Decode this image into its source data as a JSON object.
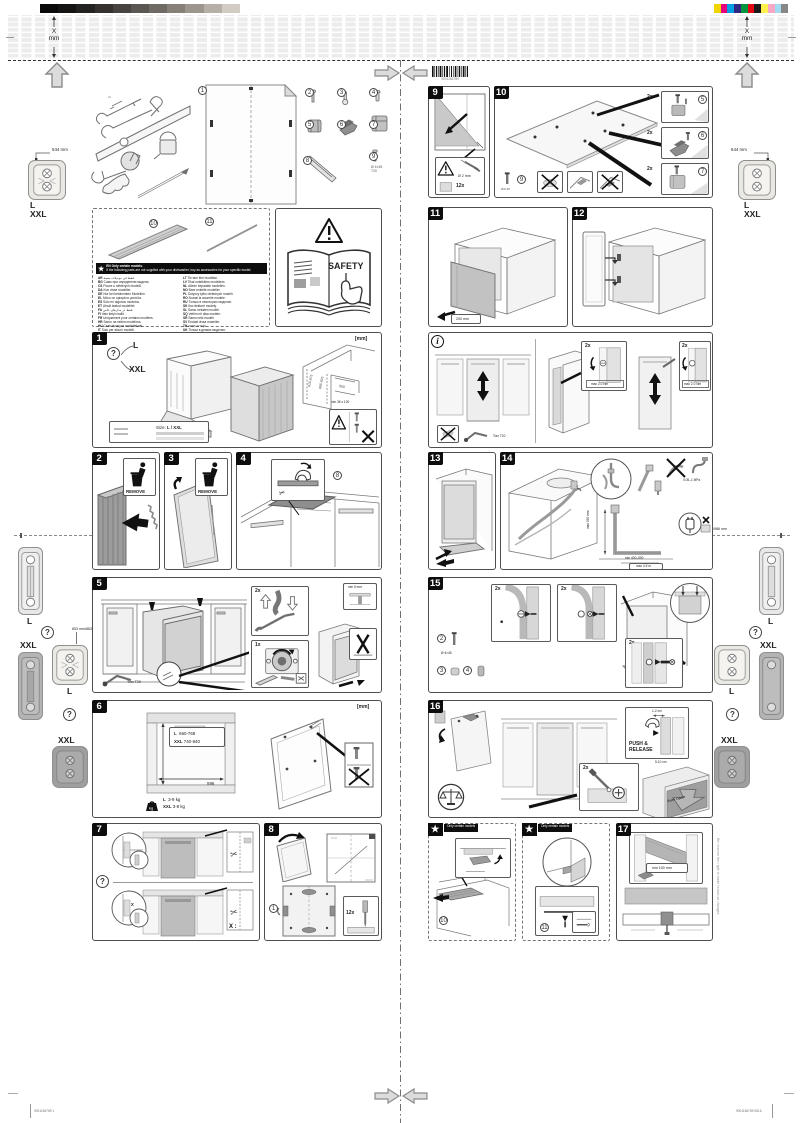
{
  "print": {
    "x_label": "X",
    "mm_label": "mm",
    "barcode_text": "9001156789",
    "footer_left": "9001156789 1",
    "footer_right": "9001156789  0816"
  },
  "flaps": {
    "dim_top": "544 mm",
    "dim_mid_left": "853 mm/863 mm",
    "dim_mid_right": "966 mm/986 mm",
    "l": "L",
    "xxl": "XXL",
    "q": "?"
  },
  "parts": {
    "p1": "1",
    "p2": "2",
    "p3": "3",
    "p4": "4",
    "p5": "5",
    "p6": "6",
    "p7": "7",
    "p8": "8",
    "p9": "9",
    "p10": "10",
    "p11": "11",
    "note1": "Ø 4×45",
    "note2": "T20"
  },
  "lang_panel": {
    "star": "★",
    "header1": "EN  Only certain models.",
    "header2": "If the following parts are not supplied with your dishwasher, buy as accessories for your specific model.",
    "columns": {
      "left": [
        {
          "code": "AR",
          "text": "فقط في موديلات معينة."
        },
        {
          "code": "BG",
          "text": "Само при определени модели."
        },
        {
          "code": "CS",
          "text": "Pouze u některých modelů."
        },
        {
          "code": "DA",
          "text": "Kun visse modeller."
        },
        {
          "code": "DE",
          "text": "Nur bei bestimmten Modellen."
        },
        {
          "code": "EL",
          "text": "Μόνο σε ορισμένα μοντέλα."
        },
        {
          "code": "ES",
          "text": "Sólo en algunos modelos."
        },
        {
          "code": "ET",
          "text": "Ainult teatud mudelitel."
        },
        {
          "code": "FA",
          "text": "فقط در مدل‌های خاص."
        },
        {
          "code": "FI",
          "text": "Vain tietyt mallit."
        },
        {
          "code": "FR",
          "text": "Uniquement pour certains modèles."
        },
        {
          "code": "HR",
          "text": "Samo na nekim modelima."
        },
        {
          "code": "HU",
          "text": "Csak bizonyos modelleknél."
        },
        {
          "code": "IT",
          "text": "Solo per alcuni modelli."
        },
        {
          "code": "KK",
          "text": "Тек белгілі бір үлгілерде."
        }
      ],
      "right": [
        {
          "code": "LT",
          "text": "Tik tam tikri modeliai."
        },
        {
          "code": "LV",
          "text": "Tikai noteiktiem modeļiem."
        },
        {
          "code": "NL",
          "text": "Alleen bepaalde modellen."
        },
        {
          "code": "NO",
          "text": "Bare enkelte modeller."
        },
        {
          "code": "PL",
          "text": "Dotyczy tylko niektórych modeli."
        },
        {
          "code": "RO",
          "text": "Numai la anumite modele."
        },
        {
          "code": "RU",
          "text": "Только в некоторых моделях."
        },
        {
          "code": "SK",
          "text": "Iba niektoré modely."
        },
        {
          "code": "SL",
          "text": "Samo nekateri modeli."
        },
        {
          "code": "SQ",
          "text": "Vetëm në disa modele."
        },
        {
          "code": "SR",
          "text": "Samo neki modeli."
        },
        {
          "code": "SV",
          "text": "Endast vissa modeller."
        },
        {
          "code": "TH",
          "text": "เฉพาะบางรุ่น"
        },
        {
          "code": "UK",
          "text": "Тільки в деяких моделях."
        },
        {
          "code": "ZH",
          "text": "仅限部分型号。"
        }
      ]
    }
  },
  "safety": {
    "label": "SAFETY"
  },
  "panels": {
    "p1": {
      "num": "1",
      "q": "?",
      "l": "L",
      "xxl": "XXL",
      "mm": "[mm]",
      "size_label": "Size:",
      "size_value": "L / XXL",
      "dim_l": "815-875",
      "dim_xxl": "865-925",
      "dim_depth": "550",
      "note": "min 36 x 100"
    },
    "p2": {
      "num": "2",
      "remove": "REMOVE"
    },
    "p3": {
      "num": "3",
      "remove": "REMOVE"
    },
    "p4": {
      "num": "4"
    },
    "p5": {
      "num": "5",
      "c2x": "2x",
      "c1x": "1x",
      "tool": "Torx T20",
      "min5": "min 5 mm"
    },
    "p6": {
      "num": "6",
      "mm": "[mm]",
      "h_l": "L",
      "h_l_v": "660-768",
      "h_xxl": "XXL",
      "h_xxl_v": "740-840",
      "w": "596",
      "wt_l": "L",
      "wt_l_v": "3-9 kg",
      "wt_xxl": "XXL",
      "wt_xxl_v": "3-8 kg"
    },
    "p7": {
      "num": "7",
      "q": "?",
      "c1x": "1x",
      "cut": "X"
    },
    "p8": {
      "num": "8",
      "c12x": "12x"
    },
    "p9": {
      "num": "9",
      "dia": "Ø 2 mm",
      "c12x": "12x"
    },
    "p10": {
      "num": "10",
      "c2x": "2x",
      "screw": "Ø 4×45"
    },
    "p11": {
      "num": "11",
      "dim": "200 mm"
    },
    "p12": {
      "num": "12"
    },
    "pi": {
      "num": "i",
      "c2x": "2x",
      "torque": "max 2.0 Nm",
      "tool": "Torx T20"
    },
    "p13": {
      "num": "13"
    },
    "p14": {
      "num": "14",
      "pressure": "0.05–1 MPa",
      "vdim": "max 950 mm",
      "hdim": "min 400–500",
      "len": "max 4.5 m"
    },
    "p15": {
      "num": "15",
      "c2x": "2x",
      "screw": "Ø 4×45"
    },
    "p16": {
      "num": "16",
      "c2x": "2x",
      "gap_top": "1-2 cm",
      "push1": "PUSH &",
      "push2": "RELEASE",
      "gap_bottom": "5-10 cm",
      "auto": "Auto Open"
    },
    "p17": {
      "num": "17",
      "dim": "min 100 mm",
      "side_note": "We reserve the right to make technical changes."
    },
    "sA": {
      "num": "★",
      "header": "Only certain models"
    },
    "sB": {
      "num": "★",
      "header": "Only certain models"
    }
  },
  "colors": {
    "graybar": [
      "#0a0a0a",
      "#161412",
      "#242220",
      "#35312e",
      "#474340",
      "#5a5651",
      "#6f6a64",
      "#868078",
      "#9c968e",
      "#b5afa7",
      "#d2ccc4",
      "#ffffff"
    ],
    "colorbar": [
      "#f2d500",
      "#e5007d",
      "#009fe3",
      "#312783",
      "#009640",
      "#e30613",
      "#1a1a1a",
      "#fff04d",
      "#f7a8c4",
      "#a3dbf0",
      "#878787"
    ]
  }
}
